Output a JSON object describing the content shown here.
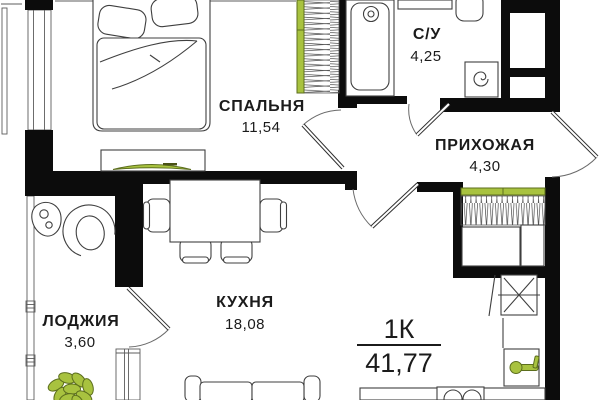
{
  "plan": {
    "kind": "apartment-floor-plan",
    "summary": {
      "type_label": "1К",
      "total_area": "41,77"
    },
    "rooms": {
      "bedroom": {
        "name": "СПАЛЬНЯ",
        "area": "11,54"
      },
      "bathroom": {
        "name": "С/У",
        "area": "4,25"
      },
      "hallway": {
        "name": "ПРИХОЖАЯ",
        "area": "4,30"
      },
      "kitchen": {
        "name": "КУХНЯ",
        "area": "18,08"
      },
      "loggia": {
        "name": "ЛОДЖИЯ",
        "area": "3,60"
      }
    },
    "colors": {
      "wall": "#0c0c0c",
      "line": "#3f3f3f",
      "accent_green": "#a8c23f",
      "accent_green_dark": "#5c6e1d",
      "background": "#ffffff",
      "text": "#1b1b1b"
    }
  }
}
